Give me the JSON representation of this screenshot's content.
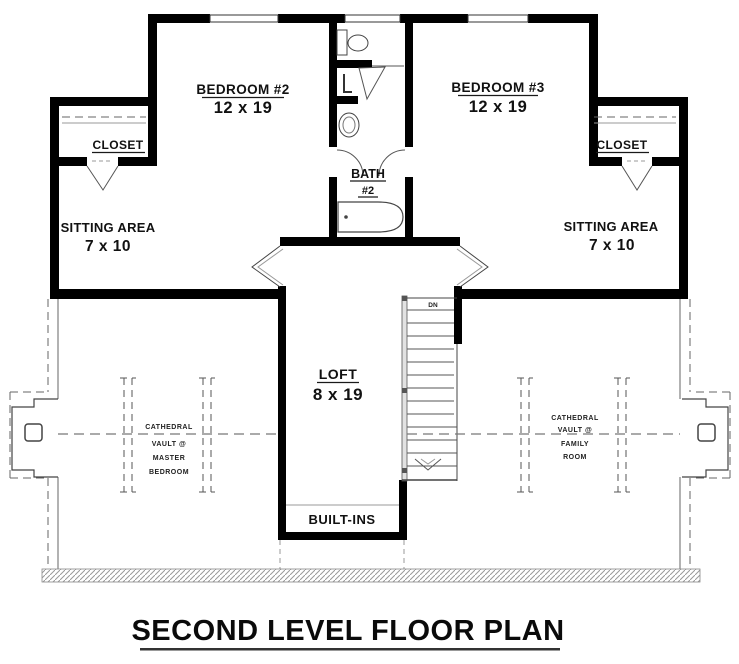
{
  "title": {
    "text": "SECOND LEVEL FLOOR PLAN"
  },
  "rooms": {
    "bedroom2": {
      "name": "BEDROOM #2",
      "dims": "12 x 19"
    },
    "bedroom3": {
      "name": "BEDROOM #3",
      "dims": "12 x 19"
    },
    "closet_left": {
      "name": "CLOSET"
    },
    "closet_right": {
      "name": "CLOSET"
    },
    "sitting_left": {
      "name": "SITTING AREA",
      "dims": "7 x 10"
    },
    "sitting_right": {
      "name": "SITTING AREA",
      "dims": "7 x 10"
    },
    "bath2": {
      "name": "BATH",
      "number": "#2"
    },
    "loft": {
      "name": "LOFT",
      "dims": "8 x 19"
    },
    "built_ins": {
      "label": "BUILT-INS"
    }
  },
  "stairs": {
    "direction_label": "DN"
  },
  "annotations": {
    "vault_left": {
      "lines": [
        "CATHEDRAL",
        "VAULT @",
        "MASTER",
        "BEDROOM"
      ]
    },
    "vault_right": {
      "lines": [
        "CATHEDRAL",
        "VAULT @",
        "FAMILY",
        "ROOM"
      ]
    }
  },
  "colors": {
    "wall": "#000000",
    "detail_line": "#555555",
    "dashed_line": "#777777",
    "background": "#ffffff"
  }
}
